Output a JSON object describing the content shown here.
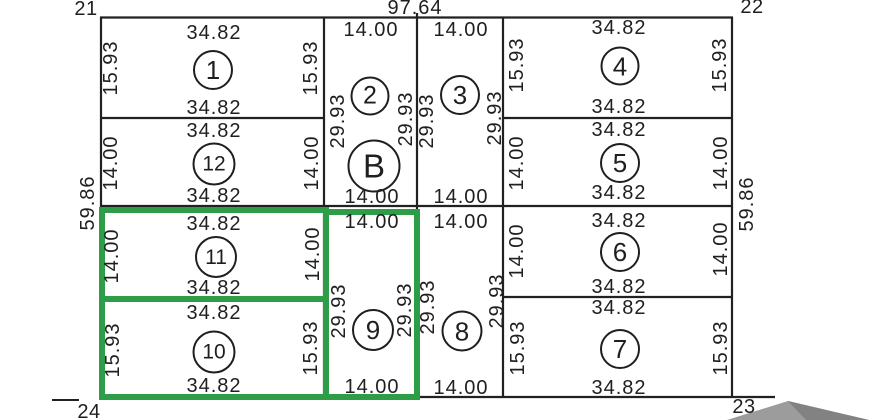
{
  "colors": {
    "bg": "#ffffff",
    "line": "#212121",
    "ink": "#1f1f1f",
    "green": "#2d9e47",
    "gray": "#9c9c9c",
    "gray-dark": "#828282"
  },
  "boundary": {
    "top_total": "97.64",
    "left_total": "59.86",
    "right_total": "59.86",
    "corner_top_left": "21",
    "corner_top_right": "22",
    "corner_bottom_right": "23",
    "corner_bottom_left": "24"
  },
  "highlighted_lots": [
    "11",
    "10",
    "9"
  ],
  "lots": [
    {
      "id": "1",
      "number": "1",
      "top": "34.82",
      "bottom": "34.82",
      "left": "15.93",
      "right": "15.93",
      "highlighted": false
    },
    {
      "id": "12",
      "number": "12",
      "top": "34.82",
      "bottom": "34.82",
      "left": "14.00",
      "right": "14.00",
      "highlighted": false
    },
    {
      "id": "11",
      "number": "11",
      "top": "34.82",
      "bottom": "34.82",
      "left": "14.00",
      "right": "14.00",
      "highlighted": true
    },
    {
      "id": "10",
      "number": "10",
      "top": "34.82",
      "bottom": "34.82",
      "left": "15.93",
      "right": "15.93",
      "highlighted": true
    },
    {
      "id": "2-B",
      "number": "2",
      "number2": "B",
      "top": "14.00",
      "bottom": "14.00",
      "left": "29.93",
      "right": "29.93",
      "highlighted": false
    },
    {
      "id": "9",
      "number": "9",
      "top": "14.00",
      "bottom": "14.00",
      "left": "29.93",
      "right": "29.93",
      "highlighted": true
    },
    {
      "id": "3",
      "number": "3",
      "top": "14.00",
      "bottom": "14.00",
      "left": "29.93",
      "right": "29.93",
      "highlighted": false
    },
    {
      "id": "8",
      "number": "8",
      "top": "14.00",
      "bottom": "14.00",
      "left": "29.93",
      "right": "29.93",
      "highlighted": false
    },
    {
      "id": "4",
      "number": "4",
      "top": "34.82",
      "bottom": "34.82",
      "left": "15.93",
      "right": "15.93",
      "highlighted": false
    },
    {
      "id": "5",
      "number": "5",
      "top": "34.82",
      "bottom": "34.82",
      "left": "14.00",
      "right": "14.00",
      "highlighted": false
    },
    {
      "id": "6",
      "number": "6",
      "top": "34.82",
      "bottom": "34.82",
      "left": "14.00",
      "right": "14.00",
      "highlighted": false
    },
    {
      "id": "7",
      "number": "7",
      "top": "34.82",
      "bottom": "34.82",
      "left": "15.93",
      "right": "15.93",
      "highlighted": false
    }
  ]
}
